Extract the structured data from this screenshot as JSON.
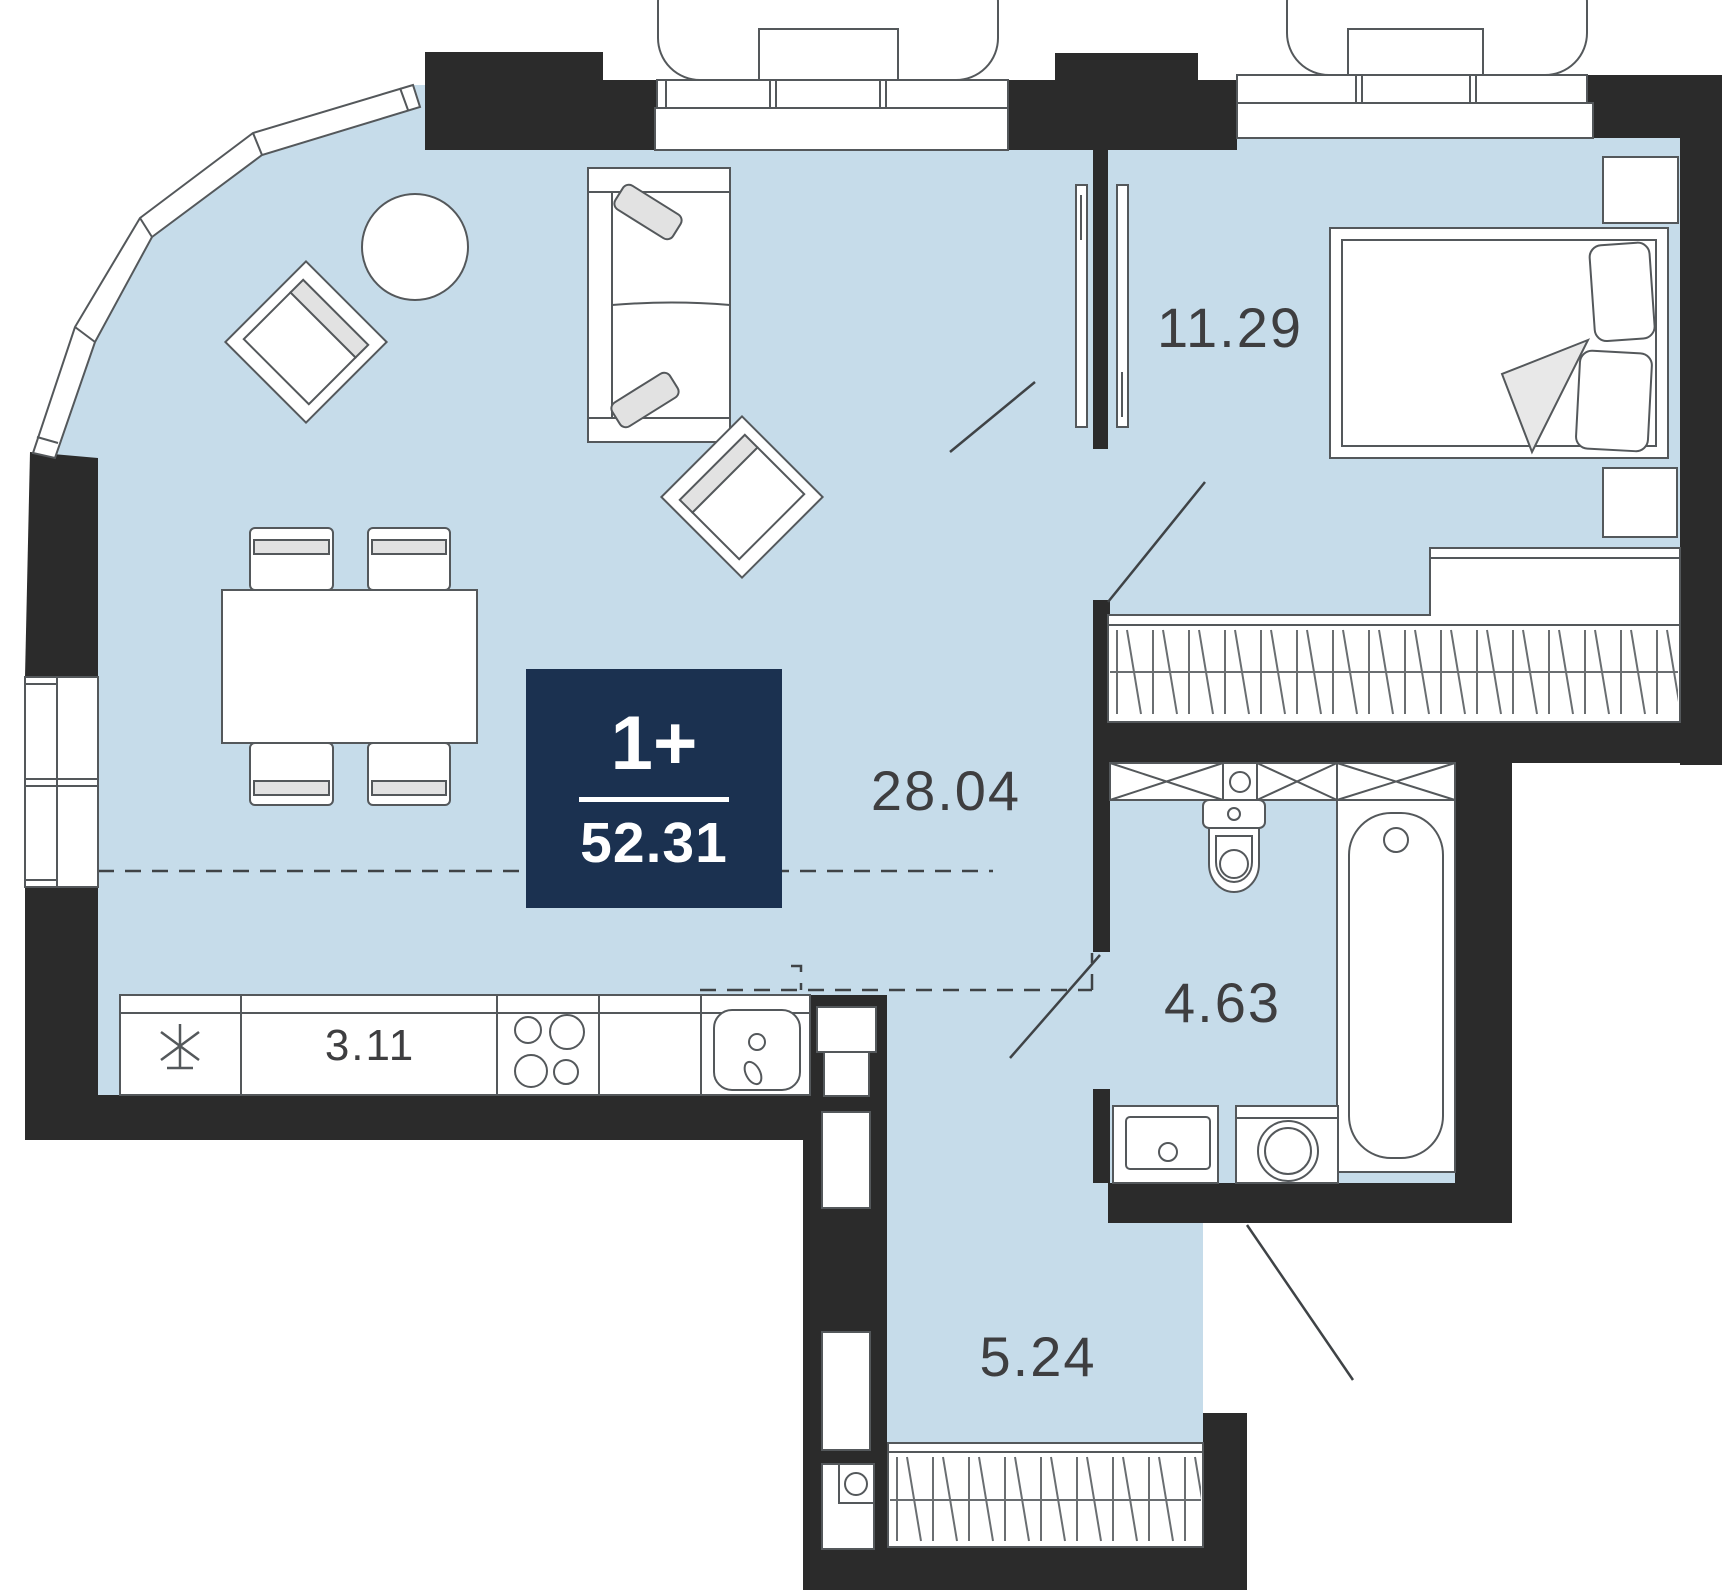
{
  "plan": {
    "type": "apartment-floor-plan",
    "badge": {
      "rooms_label": "1+",
      "total_area": "52.31"
    },
    "rooms": [
      {
        "id": "living-kitchen",
        "area": "28.04"
      },
      {
        "id": "bedroom",
        "area": "11.29"
      },
      {
        "id": "bathroom",
        "area": "4.63"
      },
      {
        "id": "hallway",
        "area": "5.24"
      },
      {
        "id": "kitchen-niche",
        "area": "3.11"
      }
    ],
    "icons": {
      "fridge": "snowflake-asterisk",
      "stove": "four-burner-circles",
      "wardrobe": "hatched-band",
      "door": "swing-arc-line"
    },
    "colors": {
      "wall": "#2b2b2b",
      "floor": "#c6dcea",
      "badge_bg": "#1b3150",
      "badge_text": "#ffffff",
      "label_text": "#3e3e40",
      "outline": "#54585b",
      "cushion": "#e2e2e2"
    }
  }
}
